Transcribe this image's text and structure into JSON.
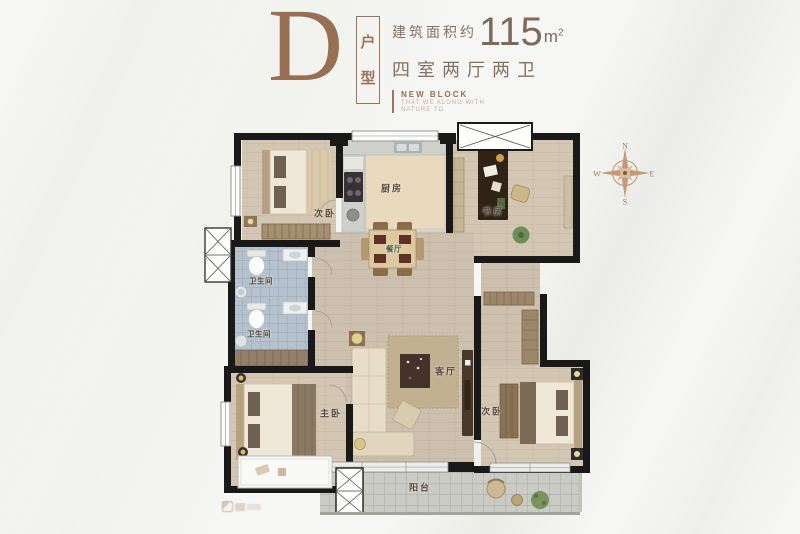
{
  "header": {
    "plan_letter": "D",
    "plan_type_chars": [
      "户",
      "型"
    ],
    "area_label": "建筑面积约",
    "area_value": "115",
    "area_unit": "m",
    "area_unit_exp": "2",
    "rooms_summary": "四室两厅两卫",
    "block_title": "NEW BLOCK",
    "block_sub1": "THAT WE ALONG WITH",
    "block_sub2": "NATURE TO"
  },
  "compass": {
    "north": "N",
    "east": "E",
    "south": "S",
    "west": "W"
  },
  "floorplan": {
    "rooms": [
      {
        "id": "bedroom-top-left",
        "label": "次卧"
      },
      {
        "id": "kitchen",
        "label": "厨房"
      },
      {
        "id": "study",
        "label": "书房"
      },
      {
        "id": "bath-top",
        "label": "卫生间"
      },
      {
        "id": "bath-bottom",
        "label": "卫生间"
      },
      {
        "id": "dining",
        "label": "餐厅"
      },
      {
        "id": "living",
        "label": "客厅"
      },
      {
        "id": "master-bedroom",
        "label": "主卧"
      },
      {
        "id": "bedroom-bottom-right",
        "label": "次卧"
      },
      {
        "id": "balcony",
        "label": "阳台"
      }
    ]
  },
  "icons": {
    "compass": "compass-rose",
    "watermark": "brand-logo"
  },
  "colors": {
    "accent_brown": "#9a7056",
    "wall": "#191919",
    "wood_floor": "#d3c6b3",
    "bath_tile": "#b5c1cc",
    "balcony_tile": "#cbcbc5",
    "kitchen_island": "#e9dabd"
  }
}
